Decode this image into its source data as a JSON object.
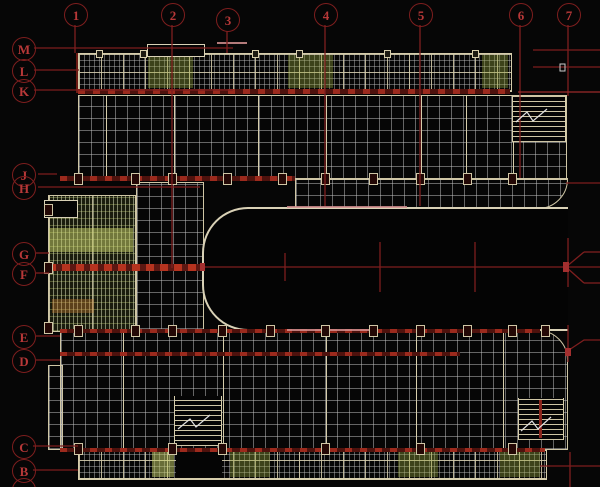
{
  "drawing": {
    "description": "CAD structural floor plan, U-shaped building with grid axes",
    "axes_top": {
      "labels": [
        "1",
        "2",
        "3",
        "4",
        "5",
        "6",
        "7"
      ]
    },
    "axes_left": {
      "labels": [
        "M",
        "L",
        "K",
        "J",
        "H",
        "G",
        "F",
        "E",
        "D",
        "C",
        "B"
      ]
    },
    "colors": {
      "background": "#060606",
      "axis_line_red": "#7e1e1e",
      "axis_text_red": "#b83838",
      "wall_cream": "#d6cdab",
      "grid_white": "#c2c2c2",
      "hatch_green": "#98a35a",
      "hatch_bright_green": "#c9d36a",
      "band_red_bright": "#a3291c",
      "band_red_dark": "#551410",
      "accent_pink": "#d49090"
    }
  }
}
